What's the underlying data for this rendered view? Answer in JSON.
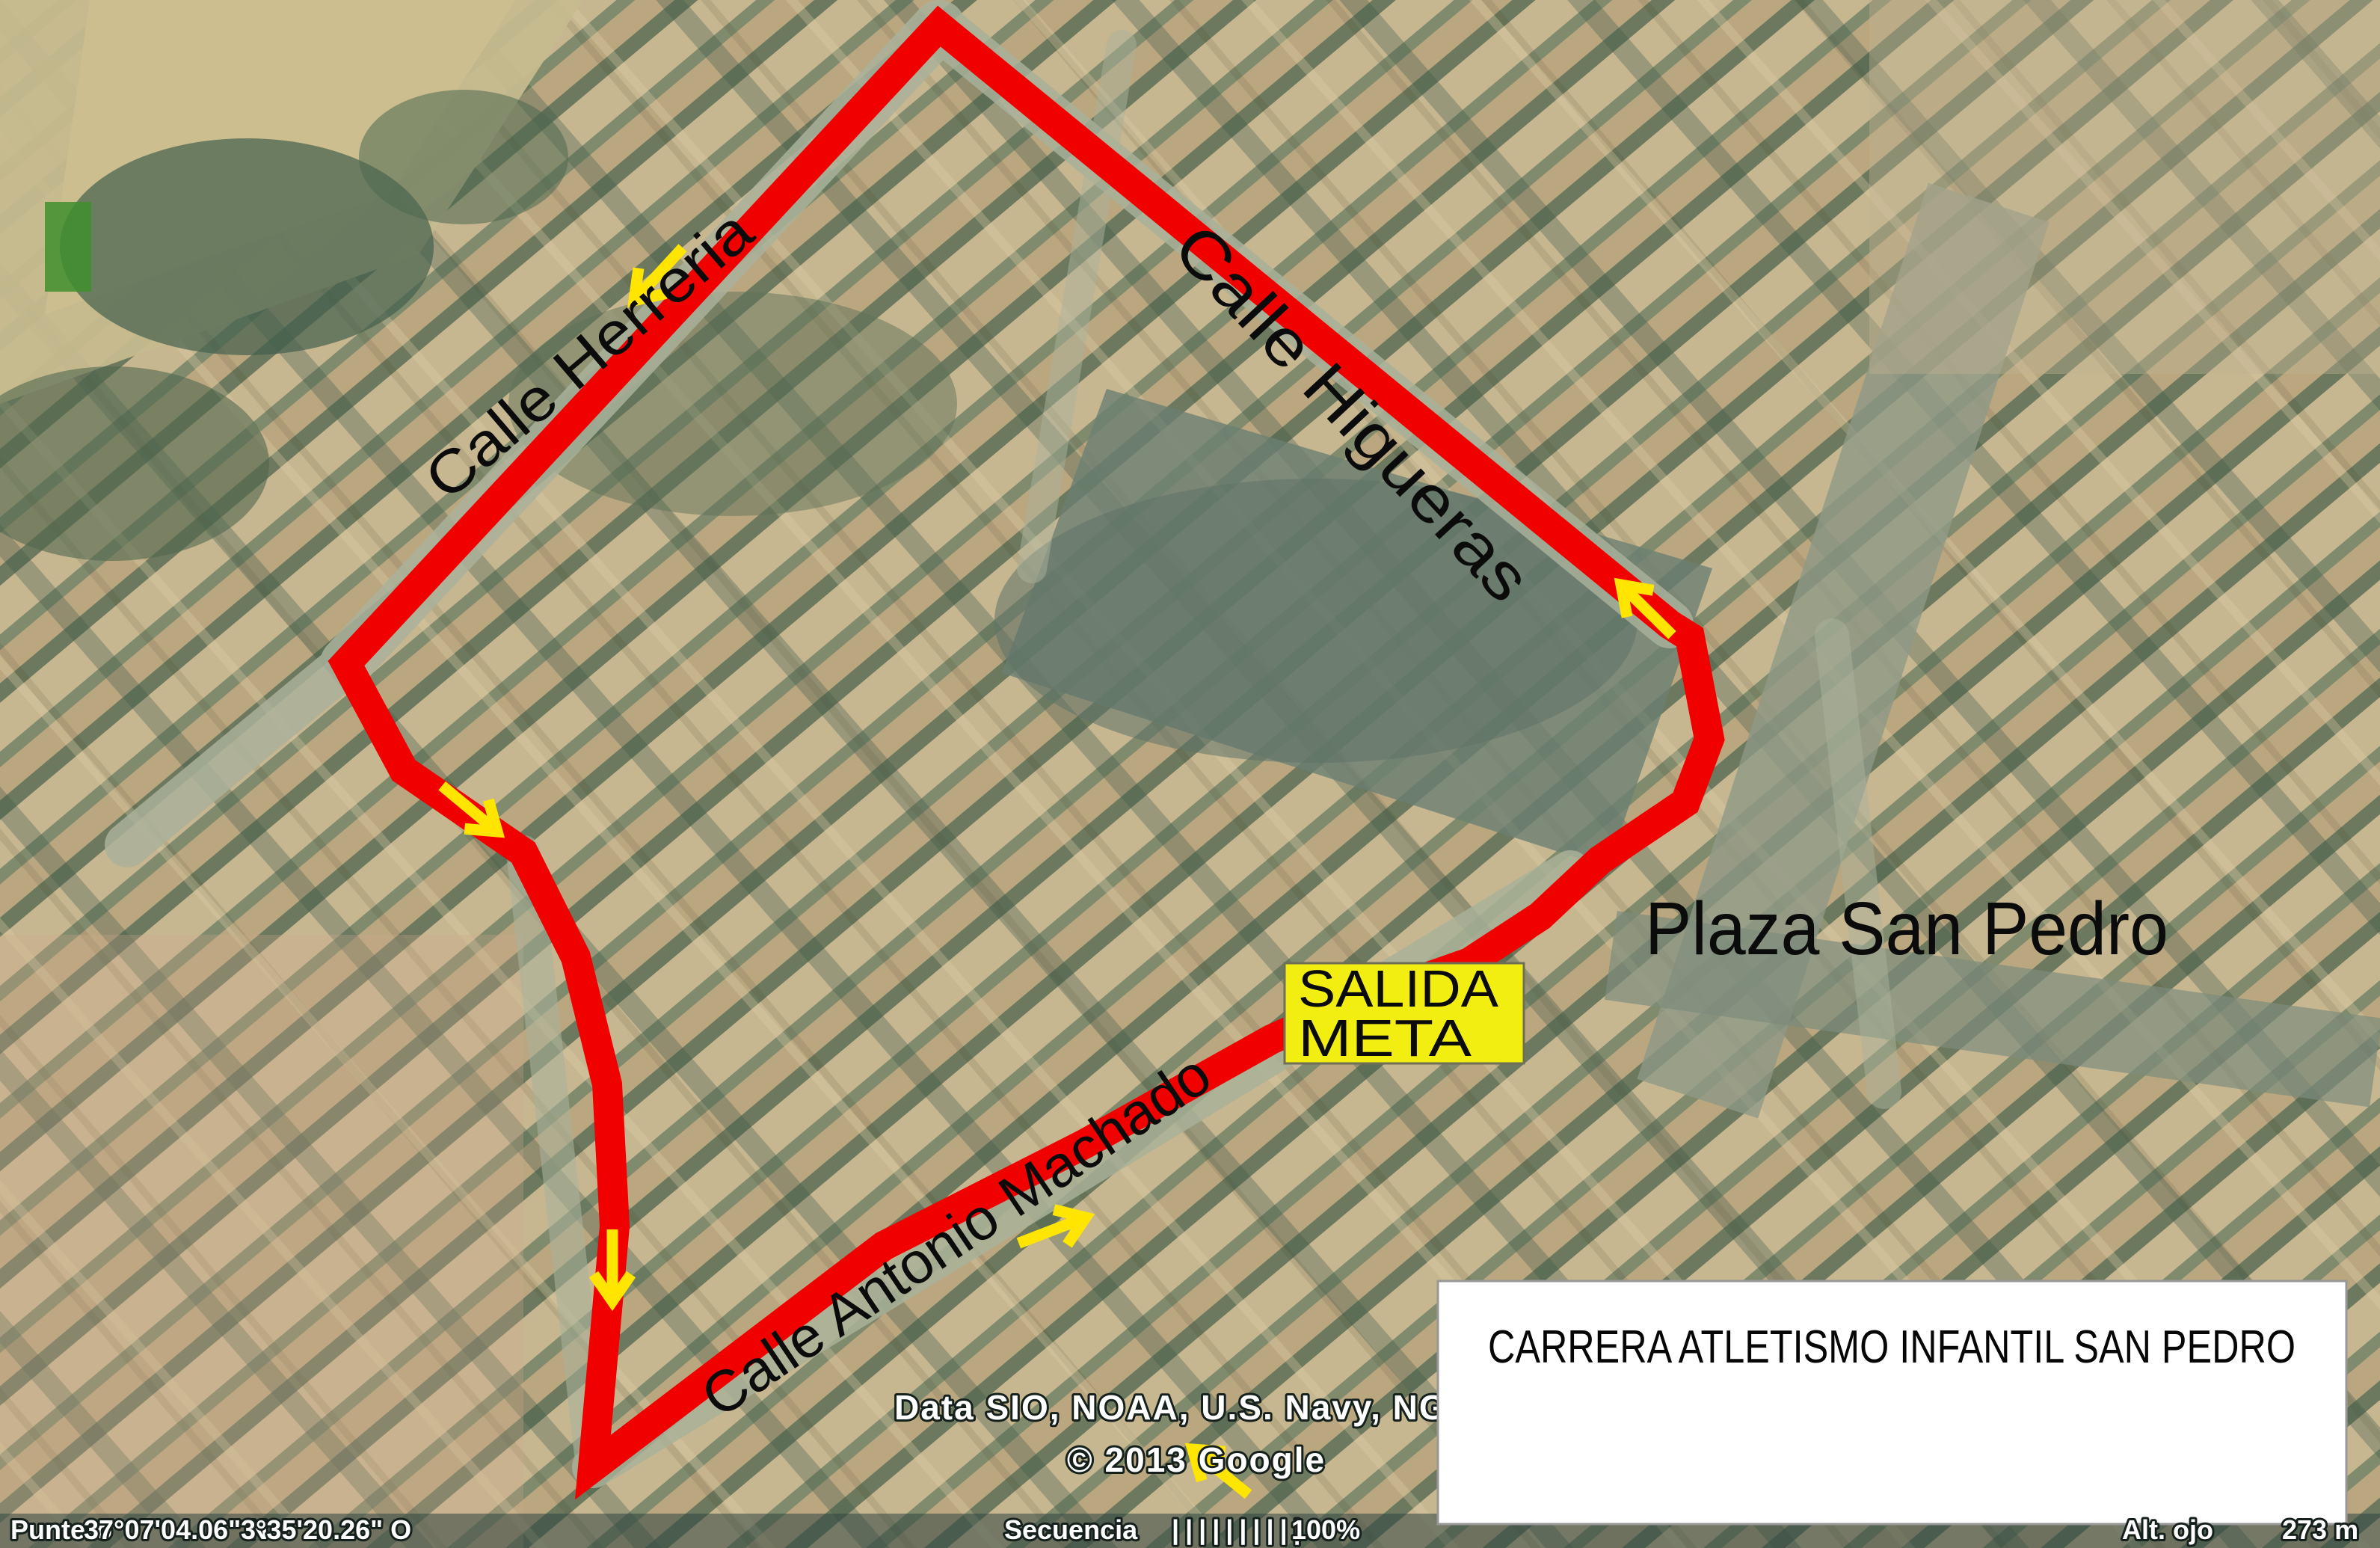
{
  "map": {
    "route_color": "#f10000",
    "arrow_color": "#ffe500",
    "streets": [
      {
        "label": "Calle Herreria"
      },
      {
        "label": "Calle Higueras"
      },
      {
        "label": "Calle Antonio Machado"
      }
    ],
    "plaza_label": "Plaza San Pedro",
    "start_finish": {
      "line1": "SALIDA",
      "line2": "META",
      "bg_color": "#f2ee12"
    }
  },
  "title_box": {
    "text": "CARRERA ATLETISMO INFANTIL SAN PEDRO"
  },
  "attribution": {
    "line1": "Data SIO, NOAA, U.S. Navy, NGA, GEB",
    "line2": "© 2013 Google"
  },
  "status_bar": {
    "pointer_label": "Puntero",
    "latitude": "37°07'04.06\" N",
    "longitude": "3°35'20.26\" O",
    "sequence_label": "Secuencia",
    "sequence_ticks": "||||||||||",
    "sequence_value": "100%",
    "eye_altitude_label": "Alt. ojo",
    "eye_altitude_value": "273 m"
  }
}
